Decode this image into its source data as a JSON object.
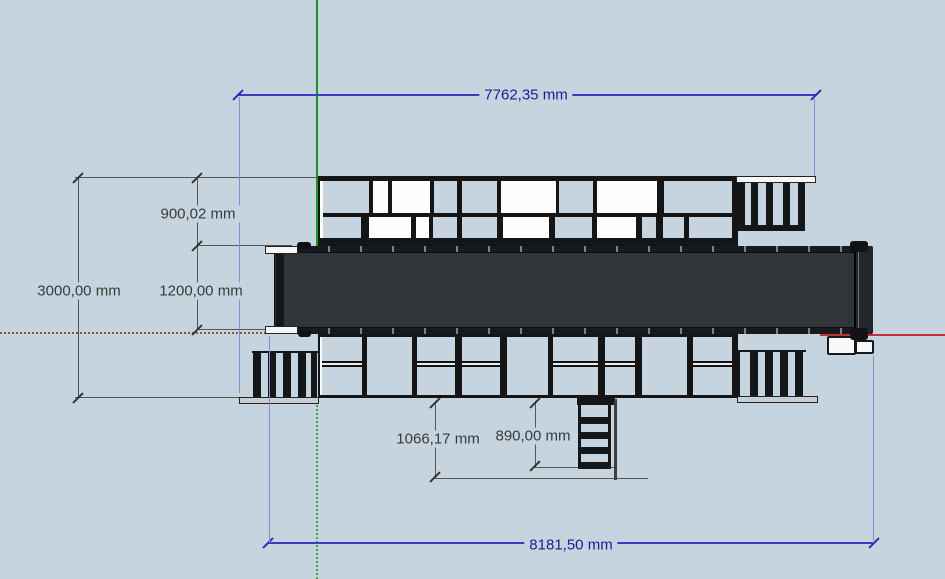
{
  "app": {
    "name": "3D CAD viewport — conveyor top view",
    "background_color": "#c5d4de",
    "unit": "mm"
  },
  "axes": {
    "green_axis_color": "#1a961e",
    "red_axis_color": "#c03434"
  },
  "dimension_colors": {
    "linear_blue": "#1c1c96",
    "linear_gray": "#3a3a3a"
  },
  "dimensions": [
    {
      "id": "top-width",
      "label": "7762,35 mm"
    },
    {
      "id": "upper-walkway-depth",
      "label": "900,02 mm"
    },
    {
      "id": "belt-depth",
      "label": "1200,00 mm"
    },
    {
      "id": "overall-depth",
      "label": "3000,00 mm"
    },
    {
      "id": "ladder-length",
      "label": "1066,17 mm"
    },
    {
      "id": "ladder-offset",
      "label": "890,00 mm"
    },
    {
      "id": "bottom-width",
      "label": "8181,50 mm"
    }
  ]
}
